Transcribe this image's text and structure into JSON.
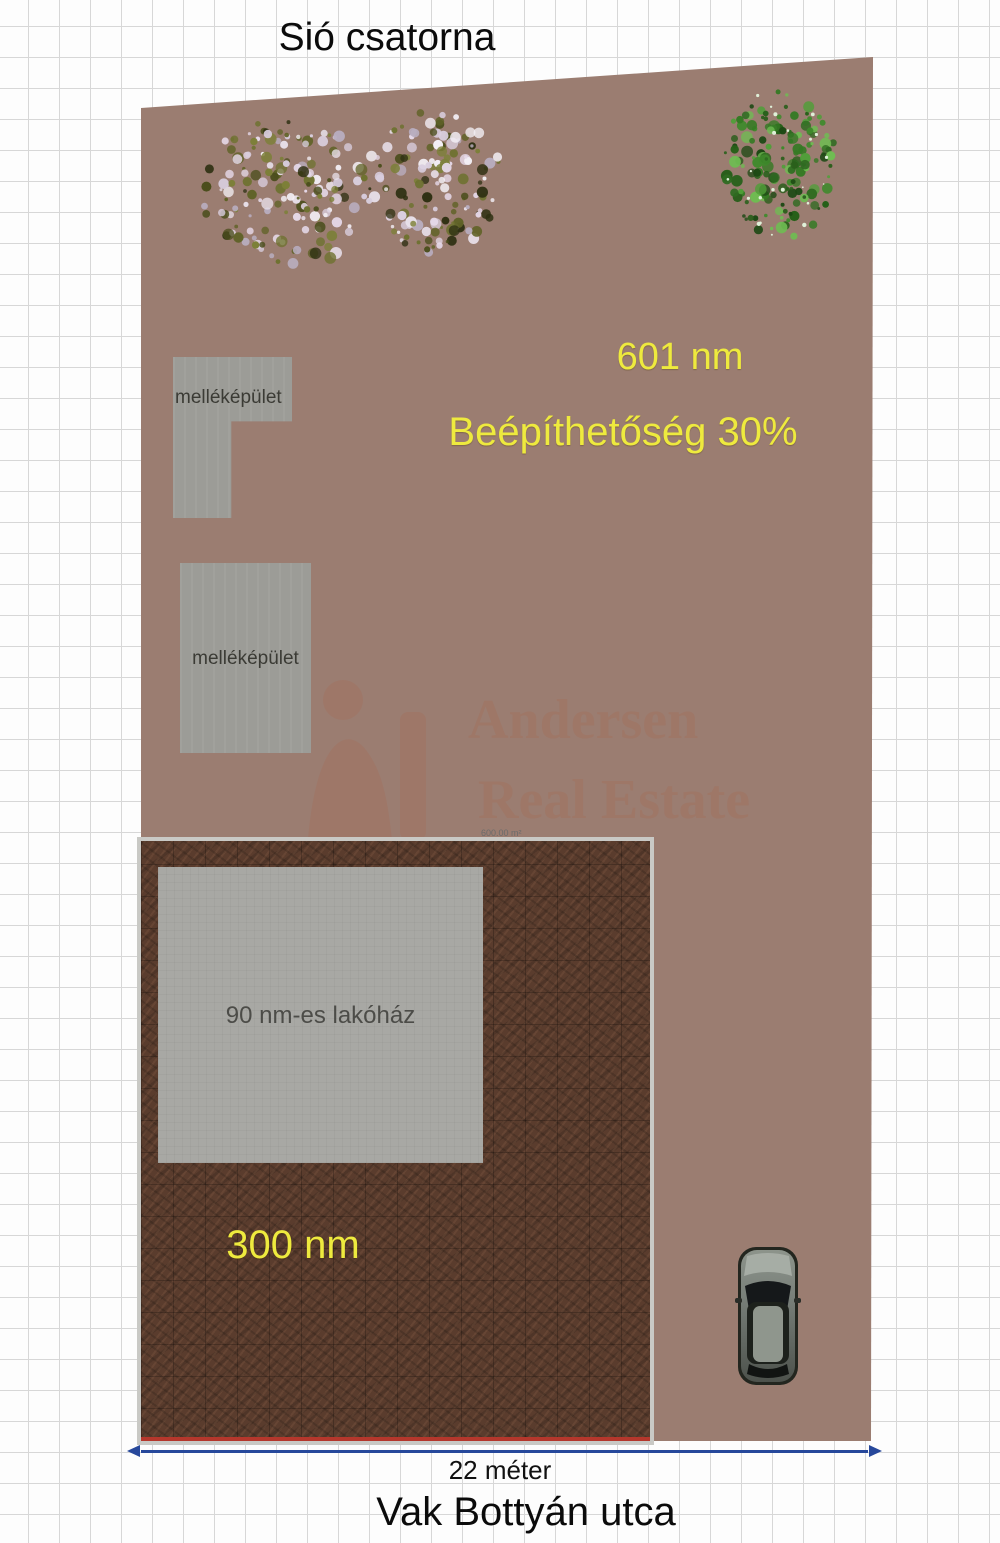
{
  "header": {
    "title": "Sió csatorna"
  },
  "footer": {
    "street": "Vak Bottyán utca",
    "width_label": "22 méter"
  },
  "plot": {
    "area_label": "601 nm",
    "buildability_label": "Beépíthetőség 30%",
    "area_detail_label": "600.00 m²"
  },
  "inner_plot": {
    "area_label": "300 nm"
  },
  "house": {
    "label": "90 nm-es lakóház"
  },
  "outbuildings": [
    {
      "label": "melléképület"
    },
    {
      "label": "melléképület"
    }
  ],
  "watermark": {
    "line1": "Andersen",
    "line2": "Real Estate"
  },
  "colors": {
    "plot": "#9b7d71",
    "inner_plot": "#5a3c2d",
    "building": "#9c9c97",
    "house": "#a8a8a4",
    "accent_yellow": "#eeea3e",
    "dimension_blue": "#27489b",
    "boundary_red": "#b5372c"
  }
}
